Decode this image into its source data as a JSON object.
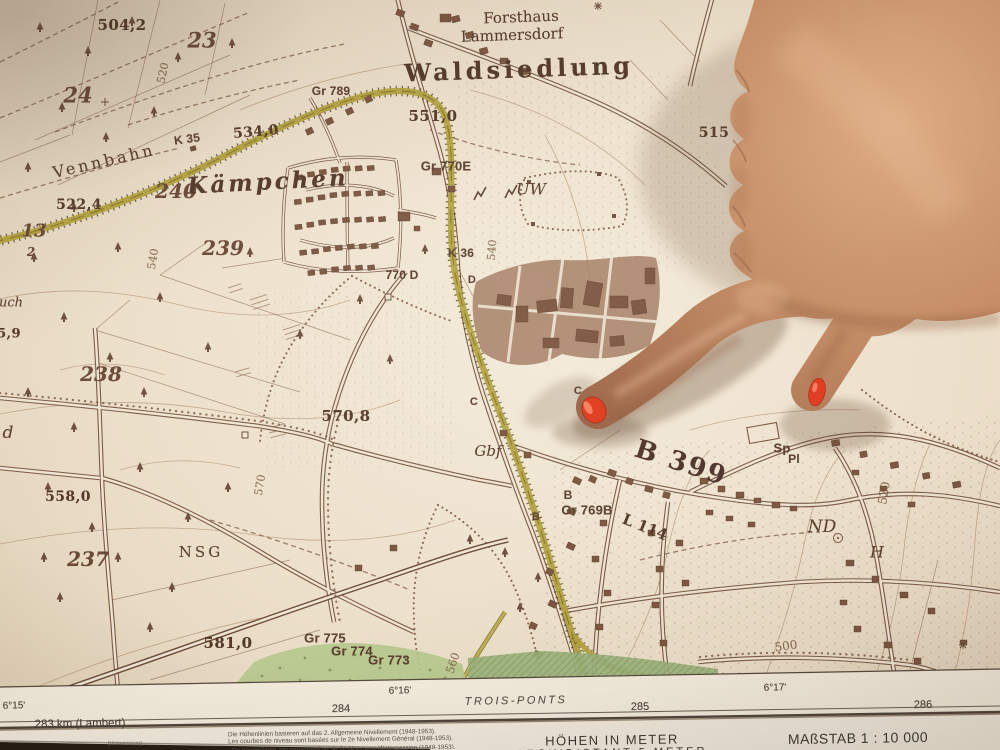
{
  "colors": {
    "desk": "#241b14",
    "paper": "#EDE2CE",
    "margin_paper": "#F3ECDD",
    "legend_paper": "#F1EBDE",
    "map_ink": "#6B4F3C",
    "building_brown": "#7B5540",
    "settlement_fill": "#A37B63",
    "railway_yellow": "#B3A23E",
    "railway_dark": "#3F3310",
    "green_light": "#B6C88E",
    "green_dark": "#9CB37C",
    "contour_brown": "#A5825F",
    "skin": "#C68E66",
    "skin_highlight": "#DCAB82",
    "skin_shadow": "#8A5638",
    "nail_red": "#E13A1C",
    "margin_text": "#46413A"
  },
  "map": {
    "labels": [
      {
        "id": "spot-504-2",
        "t": "504,2",
        "x": 122,
        "y": 25,
        "cls": "spot",
        "fs": 15
      },
      {
        "id": "parcel-23",
        "t": "23",
        "x": 202,
        "y": 40,
        "cls": "parcel",
        "fs": 21
      },
      {
        "id": "parcel-24",
        "t": "24",
        "x": 78,
        "y": 95,
        "cls": "parcel",
        "fs": 21
      },
      {
        "id": "contour-520-nw",
        "t": "520",
        "x": 163,
        "y": 73,
        "cls": "contour",
        "fs": 11,
        "rot": -78
      },
      {
        "id": "name-forsthaus",
        "t": "Forsthaus",
        "x": 521,
        "y": 17,
        "cls": "name",
        "fs": 15,
        "rot": -2
      },
      {
        "id": "name-lammersdorf-forst",
        "t": "Lammersdorf",
        "x": 512,
        "y": 35,
        "cls": "name",
        "fs": 15,
        "rot": -2
      },
      {
        "id": "name-waldsiedlung",
        "t": "Waldsiedlung",
        "x": 519,
        "y": 69,
        "cls": "name-big",
        "fs": 24,
        "rot": -2
      },
      {
        "id": "gr-789",
        "t": "Gr 789",
        "x": 331,
        "y": 91,
        "cls": "gr",
        "fs": 12
      },
      {
        "id": "spot-551-0",
        "t": "551,0",
        "x": 433,
        "y": 116,
        "cls": "spot",
        "fs": 15
      },
      {
        "id": "name-vennbahn",
        "t": "Vennbahn",
        "x": 104,
        "y": 161,
        "cls": "name-sp",
        "fs": 16,
        "rot": -13
      },
      {
        "id": "gr-k35",
        "t": "K 35",
        "x": 187,
        "y": 139,
        "cls": "gr",
        "fs": 12,
        "rot": -8
      },
      {
        "id": "spot-534-0",
        "t": "534,0",
        "x": 256,
        "y": 132,
        "cls": "spot",
        "fs": 14,
        "rot": -5
      },
      {
        "id": "spot-522-4",
        "t": "522,4",
        "x": 79,
        "y": 205,
        "cls": "spot",
        "fs": 14
      },
      {
        "id": "parcel-240",
        "t": "240",
        "x": 176,
        "y": 191,
        "cls": "parcel",
        "fs": 20
      },
      {
        "id": "name-kaempchen",
        "t": "Kämpchen",
        "x": 268,
        "y": 182,
        "cls": "town-big",
        "fs": 23,
        "rot": -3
      },
      {
        "id": "parcel-239",
        "t": "239",
        "x": 223,
        "y": 248,
        "cls": "parcel",
        "fs": 20
      },
      {
        "id": "parcel-13",
        "t": "13",
        "x": 34,
        "y": 231,
        "cls": "parcel",
        "fs": 18
      },
      {
        "id": "parcel-2",
        "t": "2",
        "x": 31,
        "y": 252,
        "cls": "parcel",
        "fs": 12
      },
      {
        "id": "gr-770e",
        "t": "Gr 770E",
        "x": 446,
        "y": 166,
        "cls": "gr",
        "fs": 13
      },
      {
        "id": "name-uw",
        "t": "UW",
        "x": 531,
        "y": 189,
        "cls": "town-italic",
        "fs": 16
      },
      {
        "id": "contour-540-e",
        "t": "540",
        "x": 492,
        "y": 250,
        "cls": "contour",
        "fs": 11,
        "rot": -85
      },
      {
        "id": "gr-k36",
        "t": "K 36",
        "x": 461,
        "y": 253,
        "cls": "gr",
        "fs": 12
      },
      {
        "id": "gr-770d",
        "t": "770 D",
        "x": 402,
        "y": 275,
        "cls": "gr",
        "fs": 12
      },
      {
        "id": "gr-d",
        "t": "D",
        "x": 472,
        "y": 280,
        "cls": "gr",
        "fs": 11
      },
      {
        "id": "parcel-238",
        "t": "238",
        "x": 101,
        "y": 374,
        "cls": "parcel",
        "fs": 20
      },
      {
        "id": "contour-540-w",
        "t": "540",
        "x": 153,
        "y": 259,
        "cls": "contour",
        "fs": 11,
        "rot": -80
      },
      {
        "id": "frag-uch",
        "t": "uch",
        "x": 11,
        "y": 303,
        "cls": "town-italic",
        "fs": 13
      },
      {
        "id": "spot-5-9",
        "t": "5,9",
        "x": 9,
        "y": 334,
        "cls": "spot",
        "fs": 13
      },
      {
        "id": "frag-d",
        "t": "d",
        "x": 8,
        "y": 433,
        "cls": "town-italic",
        "fs": 17
      },
      {
        "id": "spot-570-8",
        "t": "570,8",
        "x": 346,
        "y": 416,
        "cls": "spot",
        "fs": 15
      },
      {
        "id": "gr-c1",
        "t": "C",
        "x": 474,
        "y": 402,
        "cls": "gr",
        "fs": 11
      },
      {
        "id": "gr-c2",
        "t": "C",
        "x": 578,
        "y": 391,
        "cls": "gr",
        "fs": 11
      },
      {
        "id": "name-gbf",
        "t": "Gbf",
        "x": 488,
        "y": 451,
        "cls": "town-italic",
        "fs": 15
      },
      {
        "id": "spot-558-0",
        "t": "558,0",
        "x": 68,
        "y": 497,
        "cls": "spot",
        "fs": 14
      },
      {
        "id": "contour-570",
        "t": "570",
        "x": 260,
        "y": 485,
        "cls": "contour",
        "fs": 11,
        "rot": -80
      },
      {
        "id": "name-nsg",
        "t": "NSG",
        "x": 201,
        "y": 552,
        "cls": "name-sp",
        "fs": 15
      },
      {
        "id": "parcel-237",
        "t": "237",
        "x": 88,
        "y": 559,
        "cls": "parcel",
        "fs": 20
      },
      {
        "id": "spot-581-0",
        "t": "581,0",
        "x": 228,
        "y": 643,
        "cls": "spot",
        "fs": 15
      },
      {
        "id": "gr-775",
        "t": "Gr 775",
        "x": 325,
        "y": 638,
        "cls": "gr",
        "fs": 13
      },
      {
        "id": "gr-774",
        "t": "Gr 774",
        "x": 352,
        "y": 651,
        "cls": "gr",
        "fs": 13
      },
      {
        "id": "gr-773",
        "t": "Gr 773",
        "x": 389,
        "y": 660,
        "cls": "gr",
        "fs": 13
      },
      {
        "id": "contour-560",
        "t": "560",
        "x": 453,
        "y": 663,
        "cls": "contour",
        "fs": 11,
        "rot": -72
      },
      {
        "id": "gr-b1",
        "t": "B",
        "x": 568,
        "y": 495,
        "cls": "gr",
        "fs": 12
      },
      {
        "id": "gr-b2",
        "t": "B",
        "x": 536,
        "y": 517,
        "cls": "gr",
        "fs": 11
      },
      {
        "id": "gr-769b",
        "t": "Gr 769B",
        "x": 587,
        "y": 510,
        "cls": "gr",
        "fs": 13
      },
      {
        "id": "road-l114",
        "t": "L 114",
        "x": 645,
        "y": 527,
        "cls": "road-num",
        "fs": 15,
        "rot": 22
      },
      {
        "id": "road-b399",
        "t": "B 399",
        "x": 681,
        "y": 463,
        "cls": "road-big",
        "fs": 26,
        "rot": 18
      },
      {
        "id": "gr-sp",
        "t": "Sp",
        "x": 782,
        "y": 448,
        "cls": "gr",
        "fs": 13
      },
      {
        "id": "gr-pl",
        "t": "Pl",
        "x": 794,
        "y": 459,
        "cls": "gr",
        "fs": 12
      },
      {
        "id": "name-nd",
        "t": "ND",
        "x": 822,
        "y": 527,
        "cls": "town-italic",
        "fs": 17
      },
      {
        "id": "name-h",
        "t": "H",
        "x": 877,
        "y": 552,
        "cls": "town-italic",
        "fs": 16
      },
      {
        "id": "contour-520-e",
        "t": "520",
        "x": 884,
        "y": 493,
        "cls": "contour",
        "fs": 12,
        "rot": -80
      },
      {
        "id": "contour-500",
        "t": "500",
        "x": 786,
        "y": 646,
        "cls": "contour",
        "fs": 12,
        "rot": -8
      },
      {
        "id": "spot-515",
        "t": "515",
        "x": 714,
        "y": 133,
        "cls": "spot",
        "fs": 14
      }
    ]
  },
  "margin": {
    "labels": [
      {
        "id": "lon-6-15",
        "t": "6°15'",
        "x": 14,
        "y": 706,
        "fs": 10,
        "rot": -1
      },
      {
        "id": "lambert-283",
        "t": "283 km (Lambert)",
        "x": 80,
        "y": 724,
        "fs": 11.5,
        "rot": -1
      },
      {
        "id": "grid-284",
        "t": "284",
        "x": 341,
        "y": 709,
        "fs": 11,
        "rot": -1
      },
      {
        "id": "lon-6-16",
        "t": "6°16'",
        "x": 400,
        "y": 691,
        "fs": 10,
        "rot": -1
      },
      {
        "id": "sheet-trois-ponts",
        "t": "TROIS-PONTS",
        "x": 516,
        "y": 701,
        "cls": "m-italic",
        "fs": 11,
        "rot": -1
      },
      {
        "id": "grid-285",
        "t": "285",
        "x": 640,
        "y": 707,
        "fs": 11,
        "rot": -1
      },
      {
        "id": "lon-6-17",
        "t": "6°17'",
        "x": 775,
        "y": 688,
        "fs": 10,
        "rot": -1
      },
      {
        "id": "grid-286",
        "t": "286",
        "x": 923,
        "y": 705,
        "fs": 11,
        "rot": -1
      }
    ]
  },
  "legend": {
    "line1": "Die Höhenlinien basieren auf das 2. Allgemeine Nivellement (1948-1953).",
    "line2": "Les courbes de niveau sont basées sur le 2e Nivellement Général (1948-1953).",
    "line3": "De hoogtelijnen zijn gebaseerd op de 2e Algemene Waterpassing (1948-1953).",
    "heights_title": "HÖHEN IN METER",
    "equidistance": "AEQUIDISTANT 5 METER",
    "scale_label": "MAßSTAB 1 : 10 000",
    "partial_left": "Bildmessung"
  }
}
